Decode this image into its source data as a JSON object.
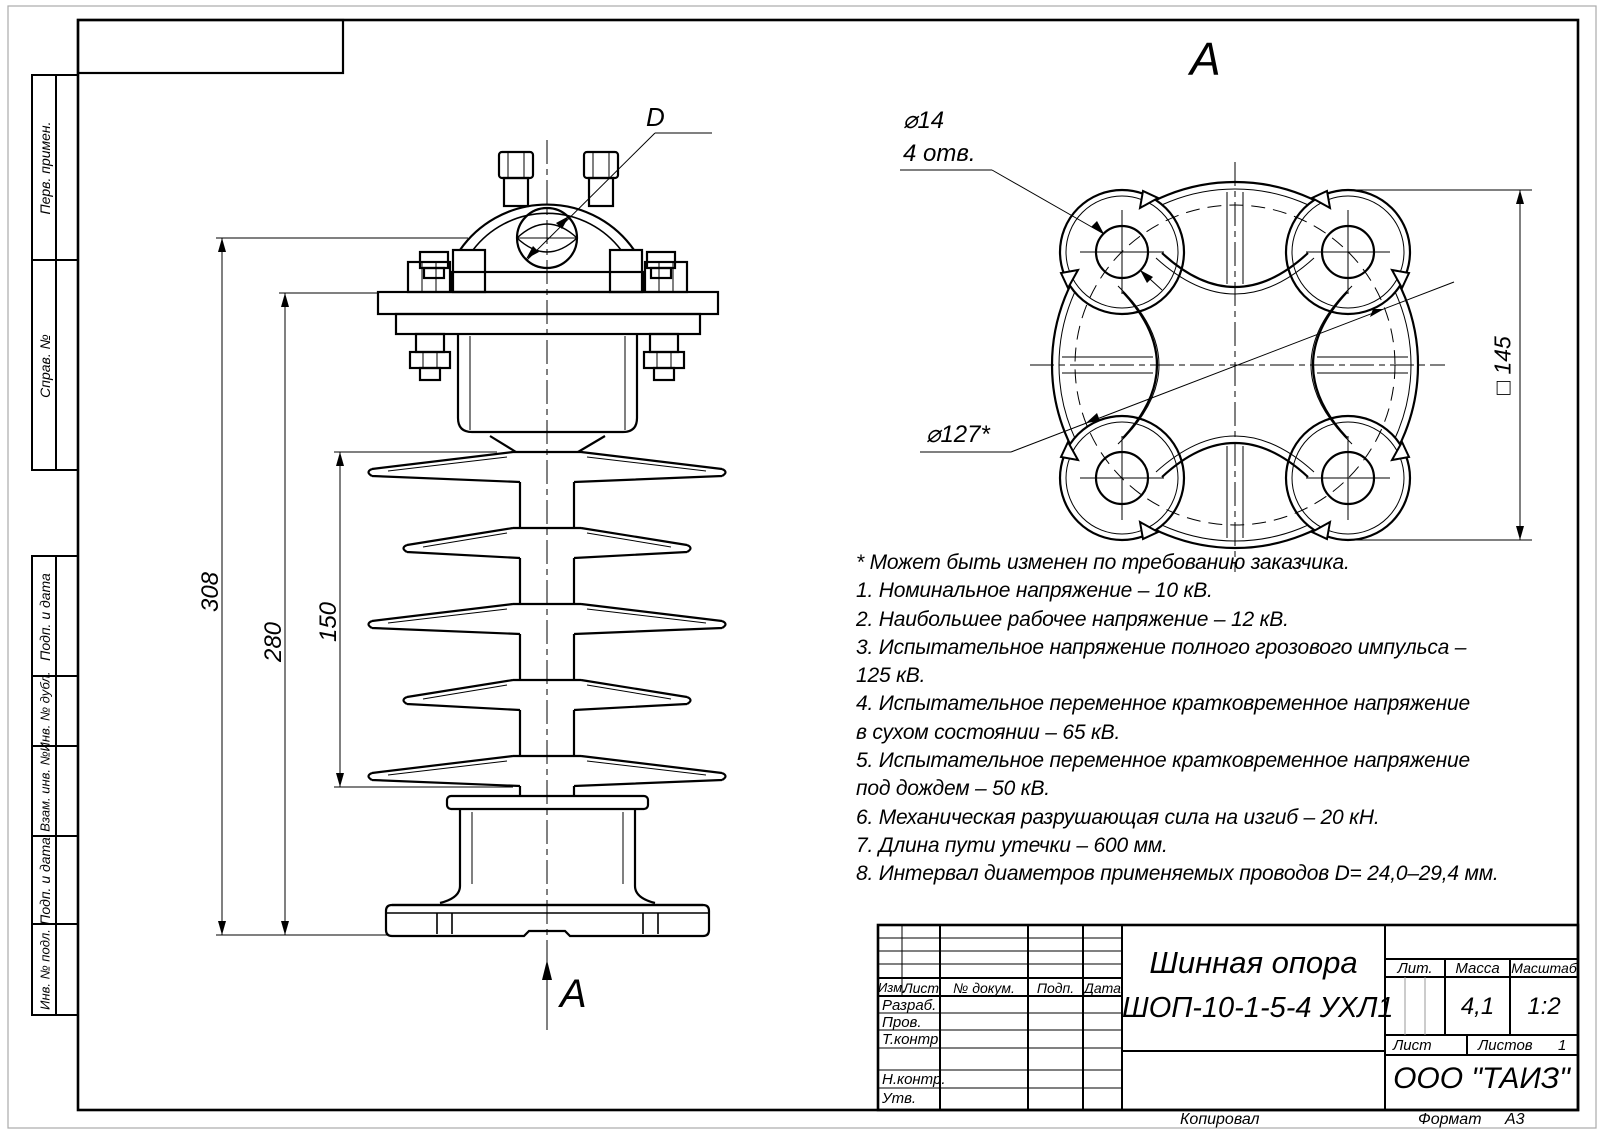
{
  "sheet": {
    "standard_view_label": "А"
  },
  "frame": {
    "left_labels": [
      "Перв. примен.",
      "Справ. №",
      "Подп. и дата",
      "Инв. № дубл.",
      "Взам. инв. №",
      "Подп. и дата",
      "Инв. № подл."
    ],
    "bottom": {
      "copied_label": "Копировал",
      "format_label": "Формат",
      "format_value": "А3"
    }
  },
  "views": {
    "front": {
      "dim_308": "308",
      "dim_280": "280",
      "dim_150": "150",
      "conductor_dim": "D",
      "section_arrow_label": "А"
    },
    "top": {
      "view_label": "А",
      "hole_dim": "⌀14",
      "hole_count": "4 отв.",
      "bolt_circle_dim": "⌀127*",
      "square_dim": "□ 145"
    }
  },
  "notes": {
    "lines": [
      "* Может быть изменен по требованию заказчика.",
      "1. Номинальное напряжение – 10 кВ.",
      "2. Наибольшее рабочее напряжение – 12 кВ.",
      "3. Испытательное напряжение полного грозового импульса –",
      "125 кВ.",
      "4. Испытательное переменное кратковременное напряжение",
      "в сухом состоянии – 65 кВ.",
      "5. Испытательное переменное кратковременное напряжение",
      "под дождем – 50 кВ.",
      "6. Механическая разрушающая сила на изгиб – 20 кН.",
      "7. Длина пути утечки – 600 мм.",
      "8. Интервал диаметров применяемых проводов D= 24,0–29,4 мм."
    ]
  },
  "title_block": {
    "columns": {
      "izm": "Изм.",
      "list": "Лист",
      "doc": "№ докум.",
      "podp": "Подп.",
      "data": "Дата"
    },
    "rows": {
      "razrab": "Разраб.",
      "prov": "Пров.",
      "tkontr": "Т.контр.",
      "nkontr": "Н.контр.",
      "utv": "Утв."
    },
    "doc_title_line1": "Шинная опора",
    "doc_title_line2": "ШОП-10-1-5-4 УХЛ1",
    "lit_label": "Лит.",
    "mass_label": "Масса",
    "scale_label": "Масштаб",
    "mass_value": "4,1",
    "scale_value": "1:2",
    "sheet_label": "Лист",
    "sheets_label": "Листов",
    "sheets_value": "1",
    "company": "ООО \"ТАИЗ\""
  },
  "colors": {
    "line": "#000000",
    "background": "#ffffff",
    "subtle": "#999999"
  }
}
